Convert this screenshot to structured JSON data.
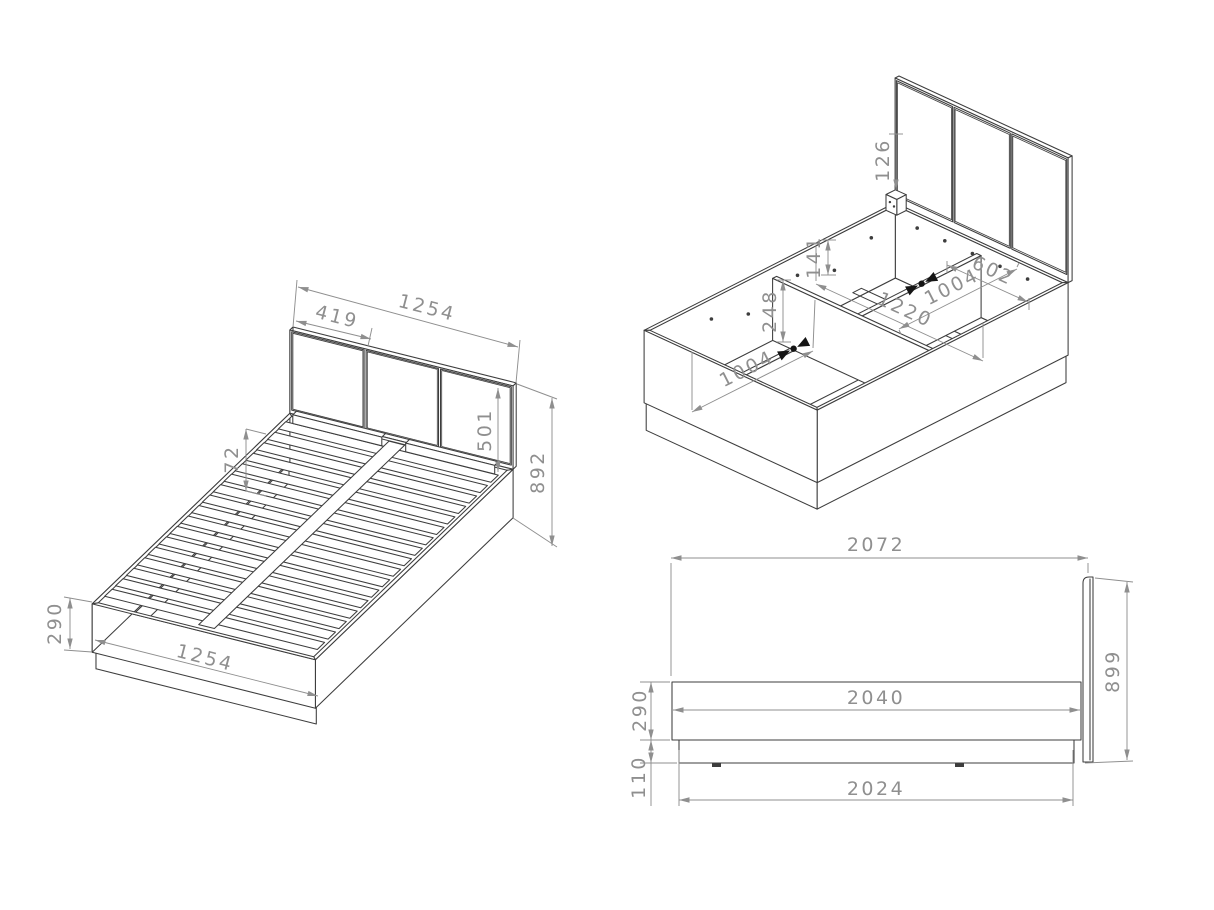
{
  "drawing_title": "Bed frame technical drawing - three views",
  "colors": {
    "background": "#ffffff",
    "line": "#3d3d3d",
    "dimension": "#8f8f8f",
    "fitting": "#151515"
  },
  "views": {
    "iso_bed_slats": {
      "name": "Isometric view - bed with slatted base",
      "dims": {
        "width_top": "1254",
        "panel_width": "419",
        "panel_height": "501",
        "total_height": "892",
        "slat_pitch": "72",
        "side_height": "290",
        "width_bottom": "1254"
      }
    },
    "iso_frame_storage": {
      "name": "Isometric view - storage frame interior",
      "dims": {
        "bracket_height": "126",
        "half_inner_width": "602",
        "inner_length_right": "1004",
        "inner_width": "1220",
        "rail_hole_offset": "141",
        "divider_height": "248",
        "inner_length_left": "1004"
      }
    },
    "side_elevation": {
      "name": "Side elevation",
      "dims": {
        "overall_length": "2072",
        "frame_length": "2040",
        "base_length": "2024",
        "frame_height": "290",
        "plinth_height": "110",
        "headboard_height": "899"
      }
    }
  }
}
